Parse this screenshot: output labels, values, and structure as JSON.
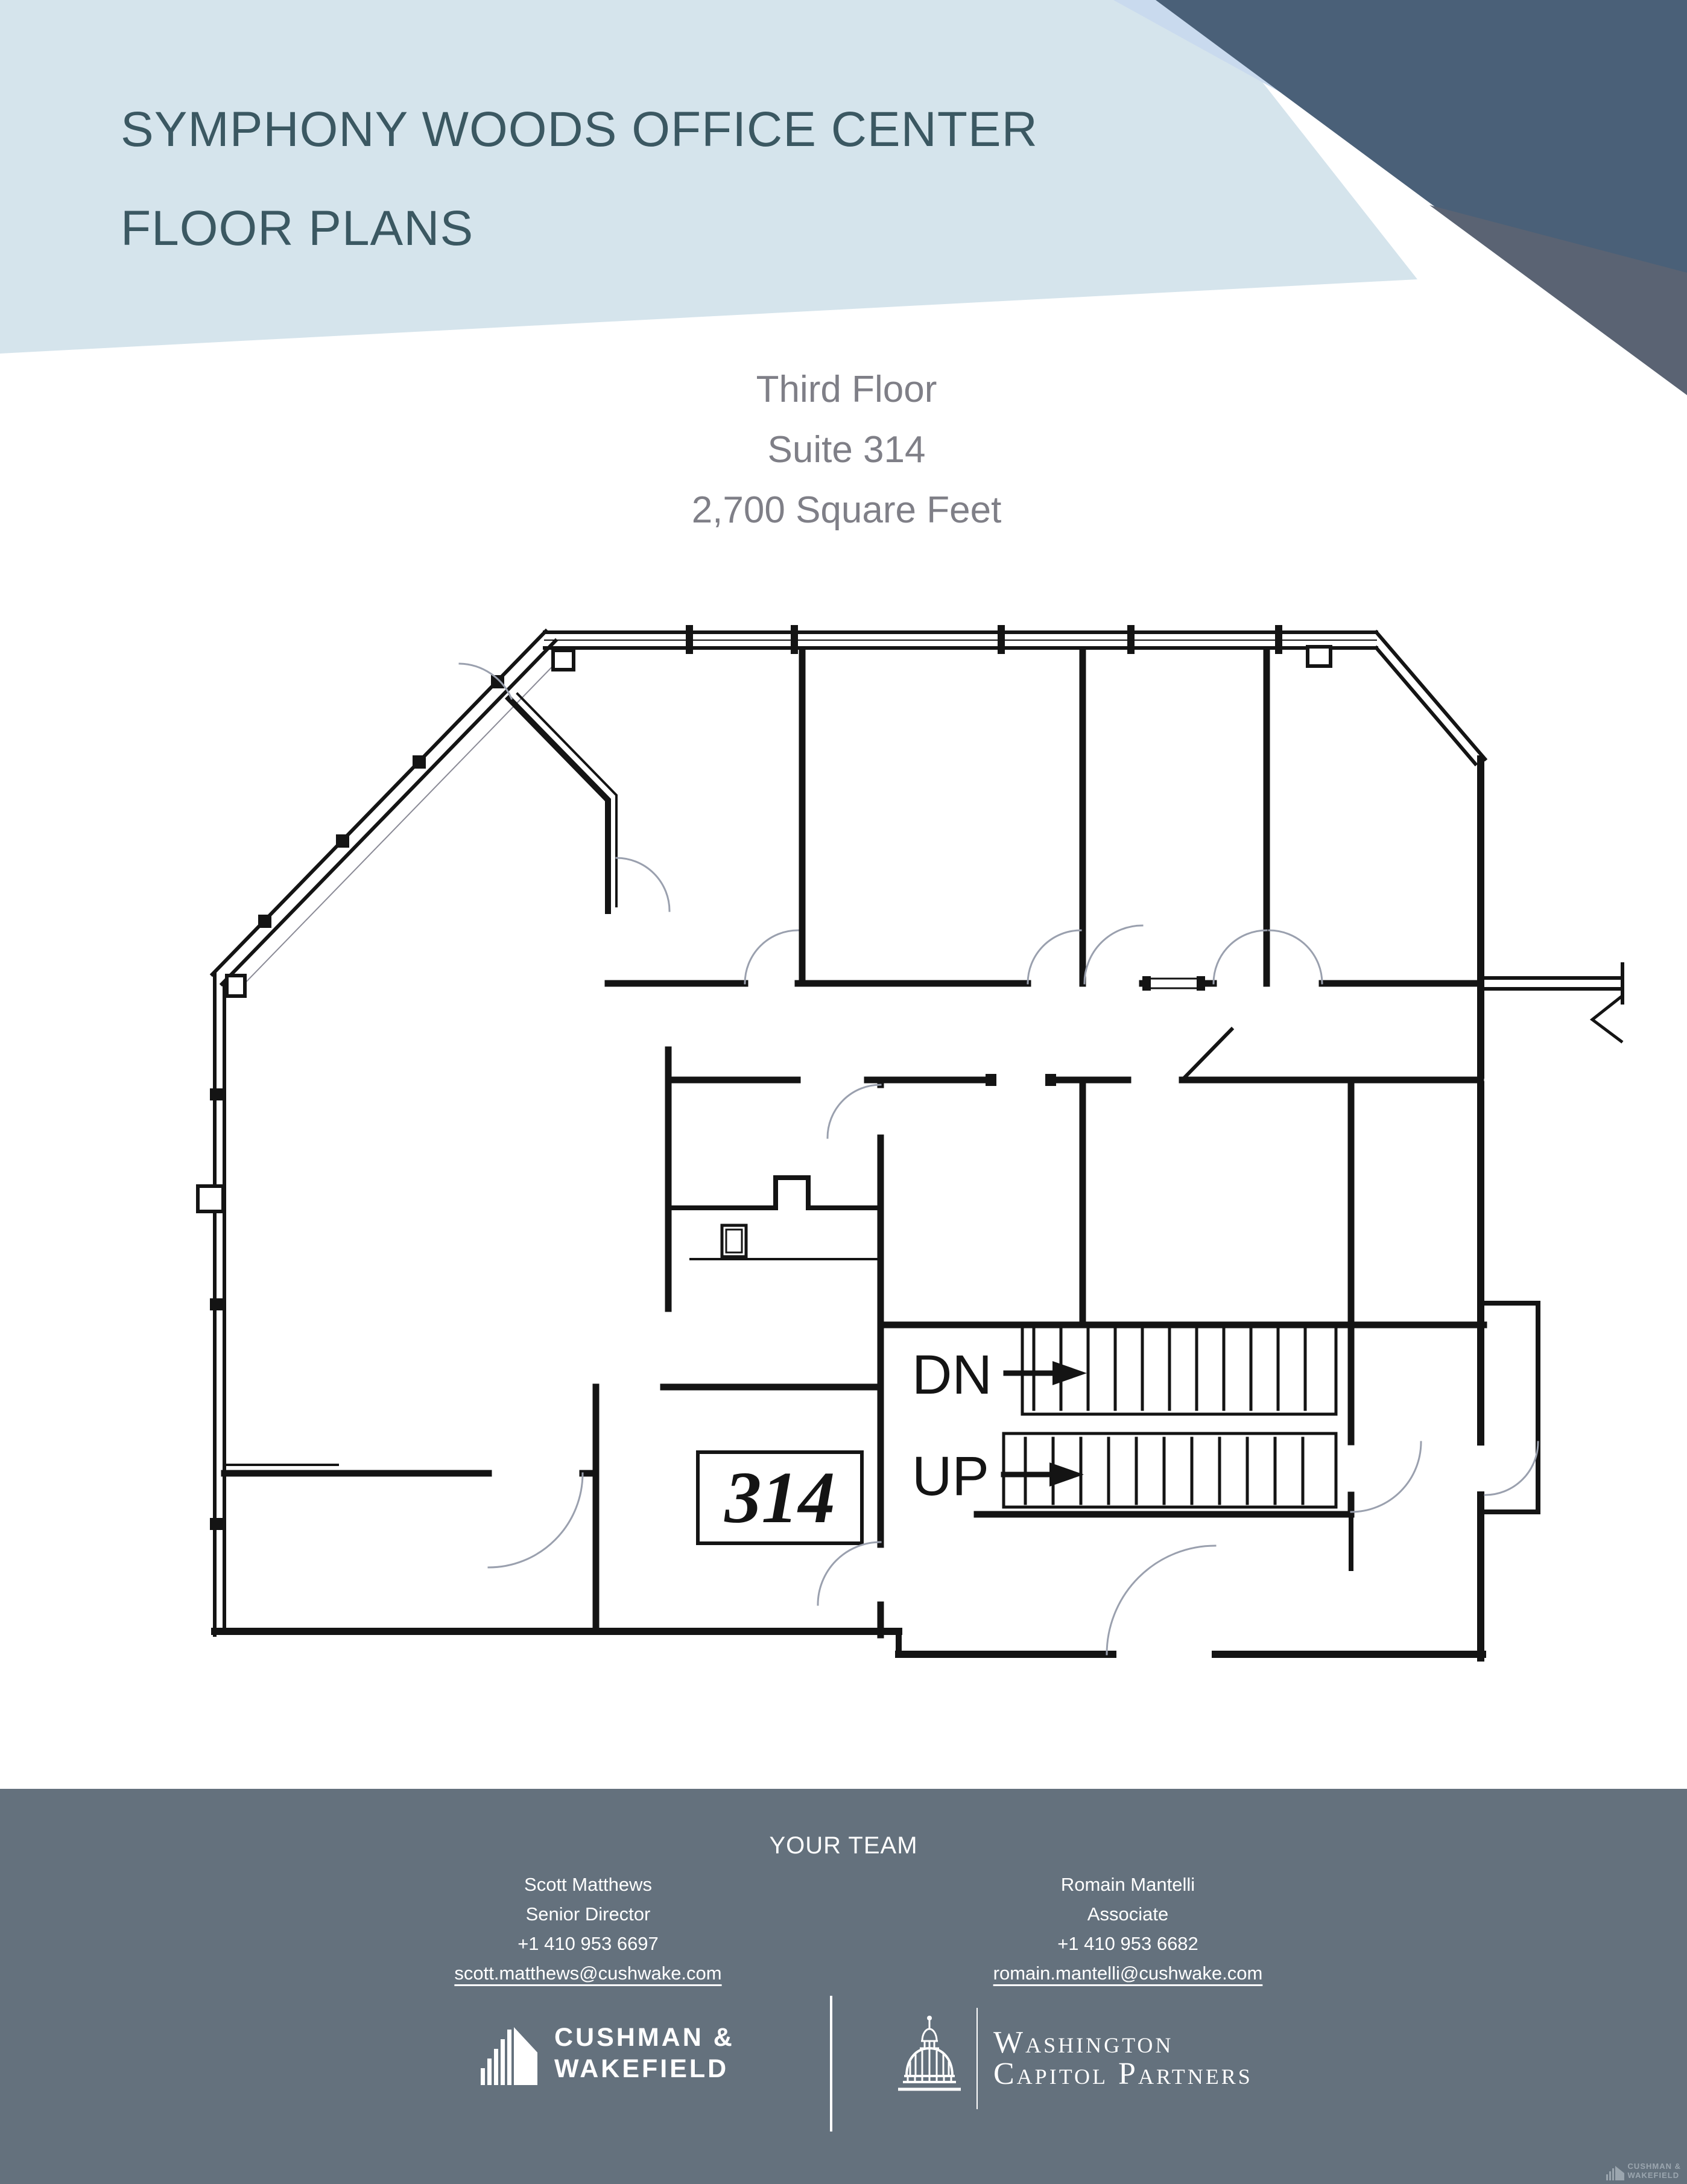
{
  "header": {
    "title_line1": "SYMPHONY WOODS OFFICE CENTER",
    "title_line2": "FLOOR PLANS"
  },
  "plan_info": {
    "line1": "Third Floor",
    "line2": "Suite 314",
    "line3": "2,700 Square Feet"
  },
  "floor_plan": {
    "suite_label": "314",
    "stair_down_label": "DN",
    "stair_up_label": "UP"
  },
  "footer": {
    "heading": "YOUR TEAM",
    "team": [
      {
        "name": "Scott Matthews",
        "title": "Senior Director",
        "phone": "+1 410 953 6697",
        "email": "scott.matthews@cushwake.com"
      },
      {
        "name": "Romain Mantelli",
        "title": "Associate",
        "phone": "+1 410 953 6682",
        "email": "romain.mantelli@cushwake.com"
      }
    ],
    "logos": {
      "cw_line1": "CUSHMAN &",
      "cw_line2": "WAKEFIELD",
      "wcp_line1": "Washington",
      "wcp_line2": "Capitol Partners"
    },
    "watermark_line1": "CUSHMAN &",
    "watermark_line2": "WAKEFIELD"
  },
  "colors": {
    "header_light_blue": "#d5e4ec",
    "header_periwinkle": "#c9daee",
    "header_dark_slate": "#4a6078",
    "header_muted_slate": "#5a6373",
    "title_text": "#3b5862",
    "subtitle_text": "#7f7f87",
    "footer_background": "#64717d",
    "plan_line": "#141414"
  }
}
